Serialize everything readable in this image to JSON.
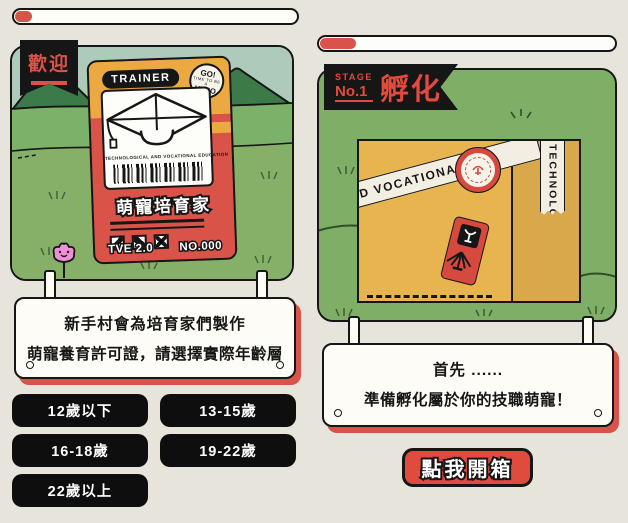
{
  "colors": {
    "background": "#e6e4db",
    "accent_red": "#d9534a",
    "panel_green": "#7fae66",
    "mountain_green": "#3c7a49",
    "sky_green": "#aecabb",
    "card_yellow": "#eaaa41",
    "card_red": "#d95348",
    "box_yellow": "#e7b450",
    "black": "#161616"
  },
  "left_panel": {
    "progress_fill_pct": 6,
    "banner_label": "歡迎",
    "card": {
      "header": "TRAINER",
      "badge_line1": "GO!",
      "badge_mid": "TIME TO BE A",
      "badge_line2": "HERO",
      "subtitle": "TECHNOLOGICAL AND VOCATIONAL EDUCATION",
      "title": "萌寵培育家",
      "version": "TVE 2.0",
      "number": "NO.000"
    },
    "sign": {
      "line1": "新手村會為培育家們製作",
      "line2": "萌寵養育許可證，請選擇實際年齡層"
    },
    "age_options": [
      "12歲以下",
      "13-15歲",
      "16-18歲",
      "19-22歲",
      "22歲以上"
    ]
  },
  "right_panel": {
    "progress_fill_pct": 12,
    "stage_label": "STAGE",
    "stage_number": "No.1",
    "stage_title": "孵化",
    "box": {
      "tape_diagonal_text": "ND VOCATIONAL E",
      "tape_vertical_text": "TECHNOLOG"
    },
    "sign": {
      "line1": "首先 ......",
      "line2": "準備孵化屬於你的技職萌寵！"
    },
    "open_box_button": "點我開箱"
  }
}
